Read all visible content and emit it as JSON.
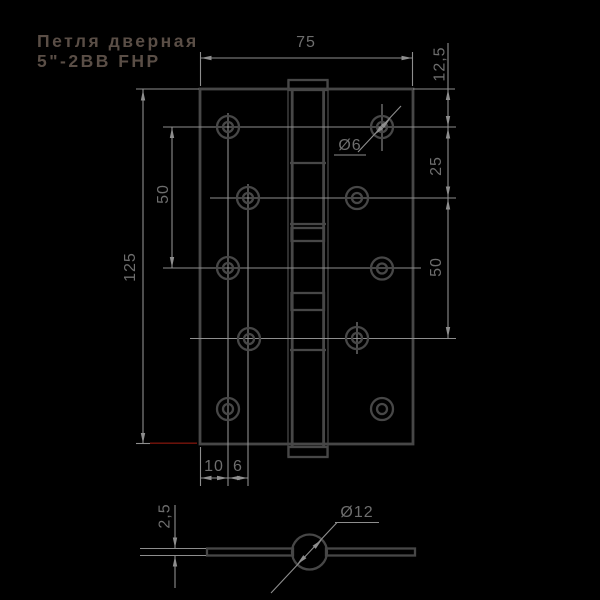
{
  "title": {
    "line1": "Петля дверная",
    "line2": "5\"-2BB FHP"
  },
  "palette": {
    "background": "#000000",
    "object_lines": "#474747",
    "dimension_lines": "#8e8e8e",
    "dimension_text": "#6e6e6e",
    "title_text": "#5a4e46",
    "accent_red": "#7a150c"
  },
  "main_view": {
    "name": "front view, hinge opened flat",
    "dim_width": "75",
    "dim_height": "125",
    "dim_edge_to_row1": "12,5",
    "dim_row1_row2": "25",
    "dim_row2_row4": "50",
    "dim_row1_row3": "50",
    "dim_edge_to_col1": "10",
    "dim_col1_col2": "6",
    "callout_screw_hole": "Ø6",
    "screw_hole_count": 10,
    "knuckle_count": 5,
    "bearing_ring_count": 2
  },
  "section_view": {
    "name": "leaf cross-section",
    "dim_leaf_thickness": "2,5",
    "callout_barrel": "Ø12"
  }
}
